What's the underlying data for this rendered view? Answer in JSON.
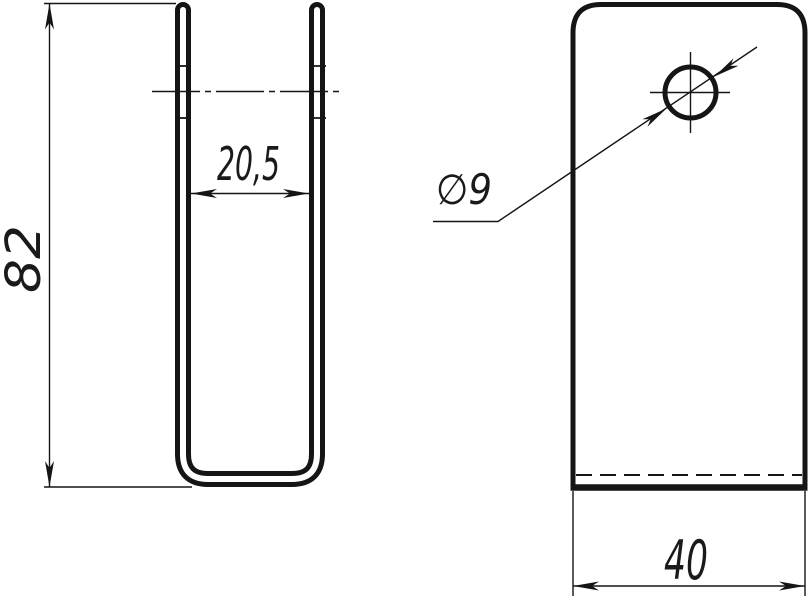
{
  "drawing": {
    "type": "two-view technical drawing of a sheet-metal U-bracket",
    "colors": {
      "line": "#151515",
      "background": "#ffffff"
    },
    "side_view": {
      "height_dim": "82",
      "inner_width_dim": "20,5"
    },
    "front_view": {
      "hole_diameter_dim": "∅9",
      "width_dim": "40"
    }
  }
}
